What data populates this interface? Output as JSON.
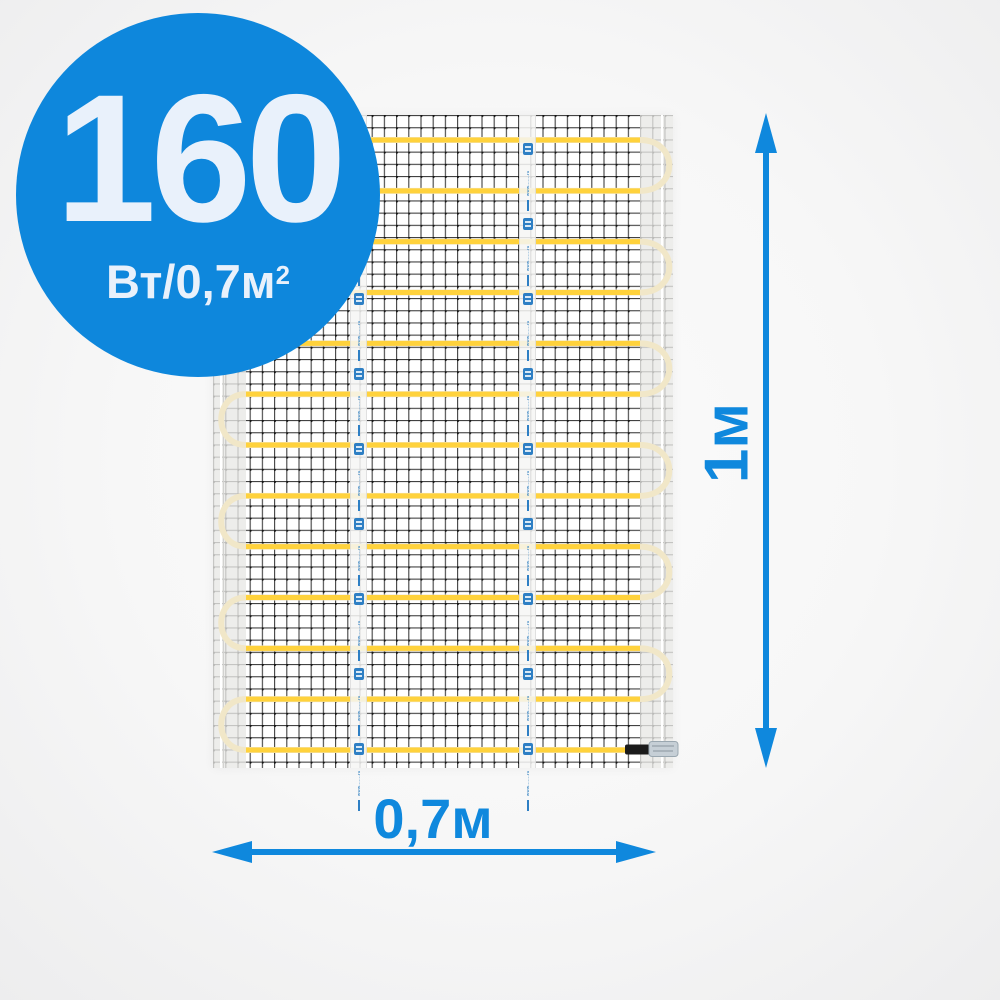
{
  "product_badge": {
    "power_value": "160",
    "power_unit": "Вт/0,7м",
    "power_unit_sup": "2"
  },
  "dimensions": {
    "height_label": "1м",
    "width_label": "0,7м"
  },
  "heating_mat": {
    "cable_rows": 13,
    "tape_count": 2,
    "tape_logo_blocks_per_tape": 9,
    "tape_website_text": "www.......ru",
    "has_end_connector": true,
    "colors": {
      "badge_blue": "#0e87dc",
      "dimension_blue": "#0f88dd",
      "badge_text": "#e9f1fb",
      "cable_yellow": "#ffd23c",
      "cable_turn_pale": "#f1e7c8",
      "mesh_line": "#2b2b2b",
      "selvedge_gray": "rgba(232,232,230,0.78)",
      "tape_logo_blue": "#2e7fc4"
    }
  }
}
